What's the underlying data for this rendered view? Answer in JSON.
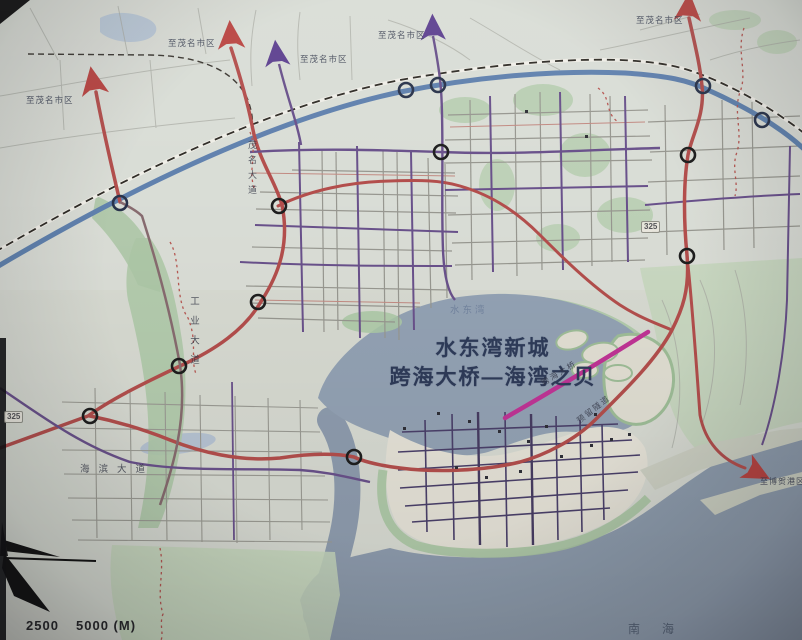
{
  "map": {
    "title_line1": "水东湾新城",
    "title_line2": "跨海大桥—海湾之贝",
    "bay_label": "水东湾",
    "sea_label": "南海",
    "arrow_labels": {
      "to_maoming": "至茂名市区",
      "to_bohe_port": "至博贺港区"
    },
    "road_labels": {
      "maoming_avenue": "茂名大道",
      "industrial_avenue": "工业大道",
      "haibin_avenue": "海滨大道",
      "cross_sea_bridge": "跨海大桥",
      "reserved_tunnel": "预留隧道",
      "national_road": "325"
    },
    "scale": {
      "half": "2500",
      "full": "5000 (M)"
    },
    "colors": {
      "land": "#d8dcd2",
      "sea": "#8d9db1",
      "bay": "#92a3b8",
      "park_green": "#aecba6",
      "expressway_blue": "#5b82b6",
      "trunk_red": "#bf4a48",
      "bridge_magenta": "#cf2d9e",
      "arterial_purple": "#6b4f92",
      "arrow_red": "#c8403c",
      "arrow_purple": "#5f3d99",
      "title_navy": "#2b3a5c"
    }
  }
}
